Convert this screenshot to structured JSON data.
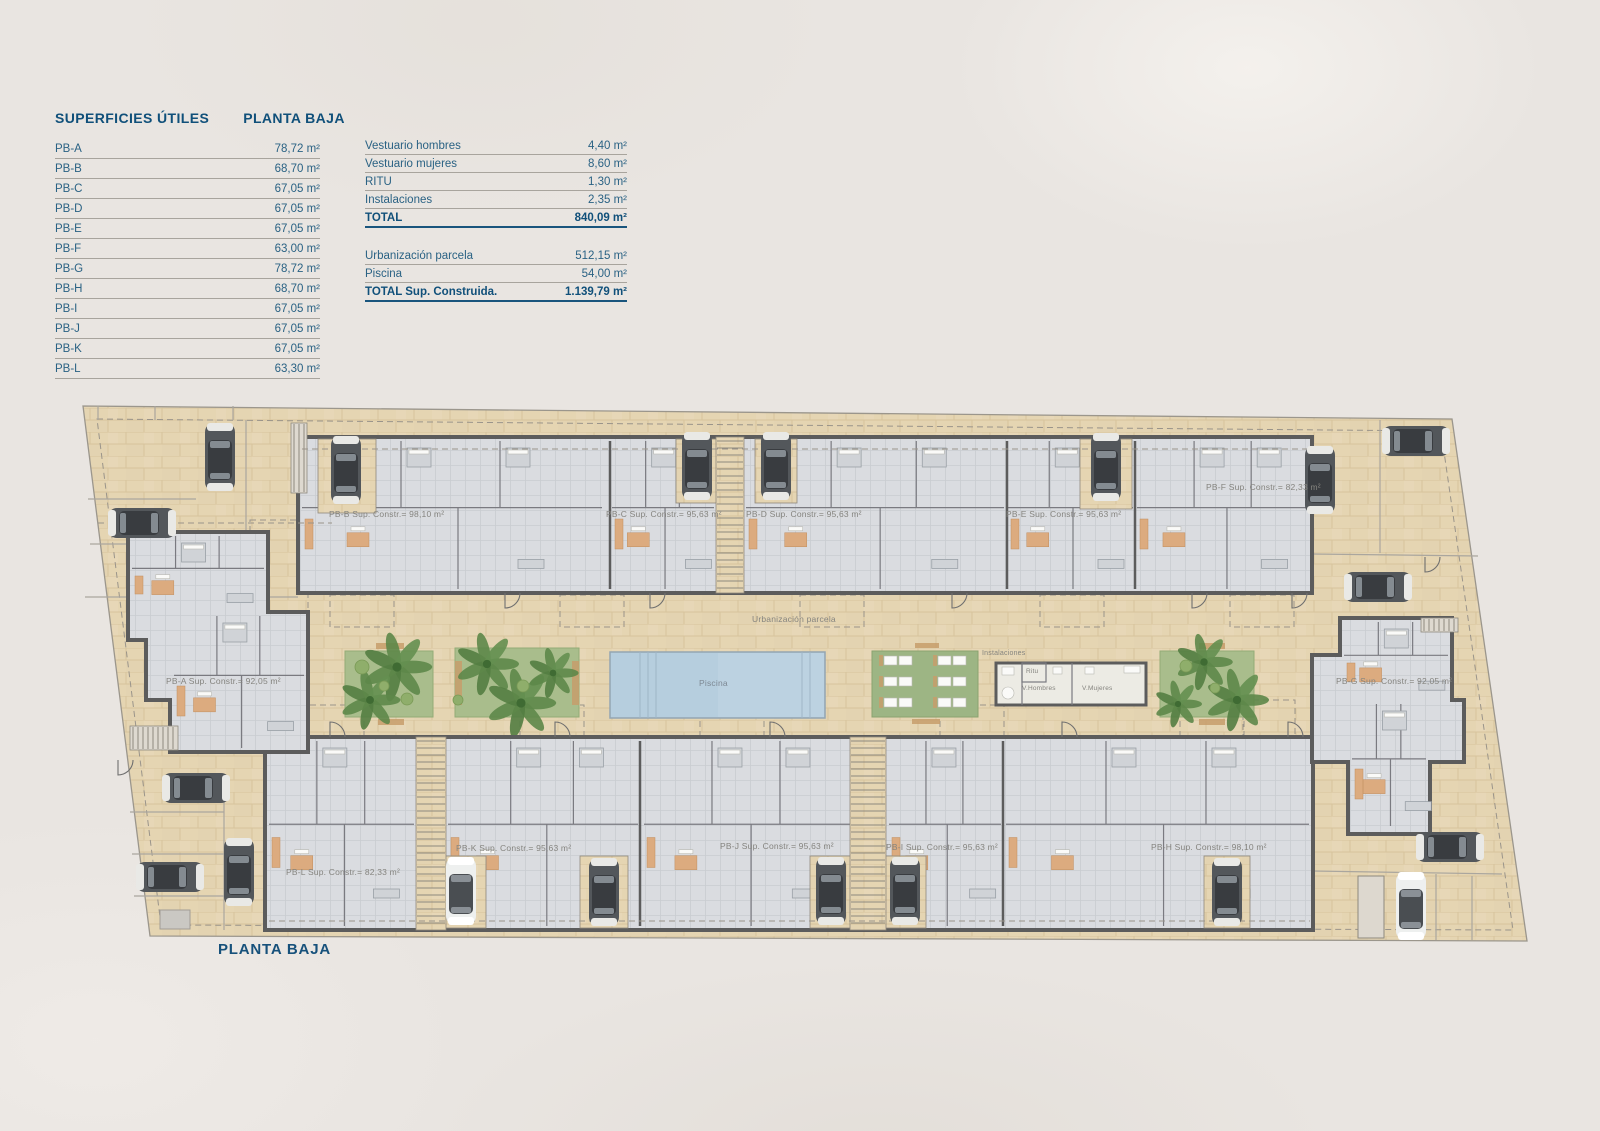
{
  "colors": {
    "ink_blue": "#10507a",
    "table_text": "#2a6284",
    "paving_tan": "#e5d5b2",
    "wall_gray": "#5c5c5c",
    "floor_gray": "#dadce0",
    "accent_orange": "#dcab7f",
    "garden_green": "#a9bd8c",
    "pool_blue": "#b6cede"
  },
  "tables": {
    "left": {
      "title": "SUPERFICIES ÚTILES",
      "subtitle": "PLANTA BAJA",
      "rows": [
        {
          "label": "PB-A",
          "value": "78,72 m²"
        },
        {
          "label": "PB-B",
          "value": "68,70 m²"
        },
        {
          "label": "PB-C",
          "value": "67,05 m²"
        },
        {
          "label": "PB-D",
          "value": "67,05 m²"
        },
        {
          "label": "PB-E",
          "value": "67,05 m²"
        },
        {
          "label": "PB-F",
          "value": "63,00 m²"
        },
        {
          "label": "PB-G",
          "value": "78,72 m²"
        },
        {
          "label": "PB-H",
          "value": "68,70 m²"
        },
        {
          "label": "PB-I",
          "value": "67,05 m²"
        },
        {
          "label": "PB-J",
          "value": "67,05 m²"
        },
        {
          "label": "PB-K",
          "value": "67,05 m²"
        },
        {
          "label": "PB-L",
          "value": "63,30 m²"
        }
      ]
    },
    "right": {
      "rows": [
        {
          "label": "Vestuario hombres",
          "value": "4,40 m²"
        },
        {
          "label": "Vestuario mujeres",
          "value": "8,60 m²"
        },
        {
          "label": "RITU",
          "value": "1,30 m²"
        },
        {
          "label": "Instalaciones",
          "value": "2,35 m²"
        }
      ],
      "total": {
        "label": "TOTAL",
        "value": "840,09 m²"
      },
      "rows2": [
        {
          "label": "Urbanización parcela",
          "value": "512,15 m²"
        },
        {
          "label": "Piscina",
          "value": "54,00 m²"
        }
      ],
      "total2": {
        "label": "TOTAL Sup. Construida.",
        "value": "1.139,79 m²"
      }
    }
  },
  "plan": {
    "caption": "PLANTA BAJA",
    "units": [
      {
        "id": "PB-A",
        "label": "PB-A Sup. Constr.= 92,05 m²"
      },
      {
        "id": "PB-B",
        "label": "PB-B Sup. Constr.= 98,10 m²"
      },
      {
        "id": "PB-C",
        "label": "PB-C Sup. Constr.= 95,63 m²"
      },
      {
        "id": "PB-D",
        "label": "PB-D Sup. Constr.= 95,63 m²"
      },
      {
        "id": "PB-E",
        "label": "PB-E Sup. Constr.= 95,63 m²"
      },
      {
        "id": "PB-F",
        "label": "PB-F Sup. Constr.= 82,33 m²"
      },
      {
        "id": "PB-G",
        "label": "PB-G Sup. Constr.= 92,05 m²"
      },
      {
        "id": "PB-H",
        "label": "PB-H Sup. Constr.= 98,10 m²"
      },
      {
        "id": "PB-I",
        "label": "PB-I Sup. Constr.= 95,63 m²"
      },
      {
        "id": "PB-J",
        "label": "PB-J Sup. Constr.= 95,63 m²"
      },
      {
        "id": "PB-K",
        "label": "PB-K Sup. Constr.= 95,63 m²"
      },
      {
        "id": "PB-L",
        "label": "PB-L Sup. Constr.= 82,33 m²"
      }
    ],
    "labels": {
      "urbanizacion": "Urbanización parcela",
      "piscina": "Piscina",
      "instalaciones": "Instalaciones",
      "ritu": "Ritu",
      "v_hombres": "V.Hombres",
      "v_mujeres": "V.Mujeres"
    }
  }
}
